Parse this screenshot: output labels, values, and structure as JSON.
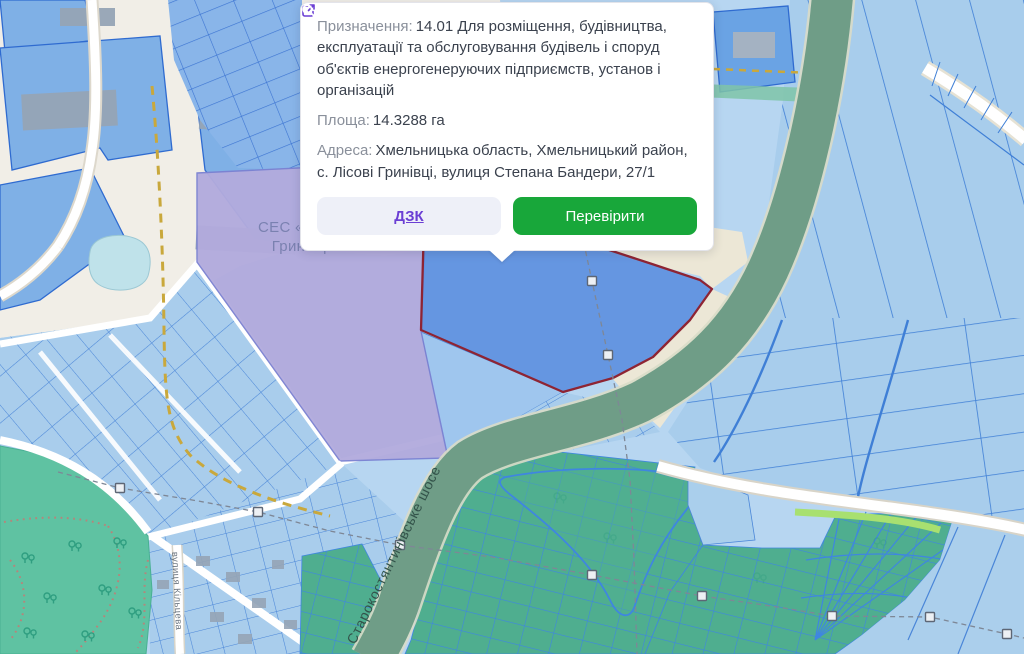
{
  "popup": {
    "purpose_label": "Призначення:",
    "purpose_value": "14.01 Для розміщення, будівництва, експлуатації та обслуговування будівель і споруд об'єктів енергогенеруючих підприємств, установ і організацій",
    "area_label": "Площа:",
    "area_value": "14.3288 га",
    "address_label": "Адреса:",
    "address_value": "Хмельницька область, Хмельницький район, с. Лісові Гринівці, вулиця Степана Бандери, 27/1",
    "dzk_button": "ДЗК",
    "verify_button": "Перевірити"
  },
  "map": {
    "labels": {
      "ses_line1": "СЕС «Лісові",
      "ses_line2": "Гринівці»",
      "highway": "Старокостянтинівське шосе",
      "street": "вулиця Кільцева"
    },
    "colors": {
      "accent_green": "#18a73a",
      "link_purple": "#6b3fd4",
      "selected_parcel_fill": "#5c8fdf",
      "selected_parcel_border": "#8e2433",
      "parcel_blue": "#a9cdec",
      "parcel_line_blue": "#3f7fd6",
      "ses_purple": "#b2abdd",
      "road_green": "#6f9d87",
      "garden_teal": "#4fae8f",
      "park_green": "#5fc2a2",
      "ground_beige": "#f1eee7"
    }
  }
}
